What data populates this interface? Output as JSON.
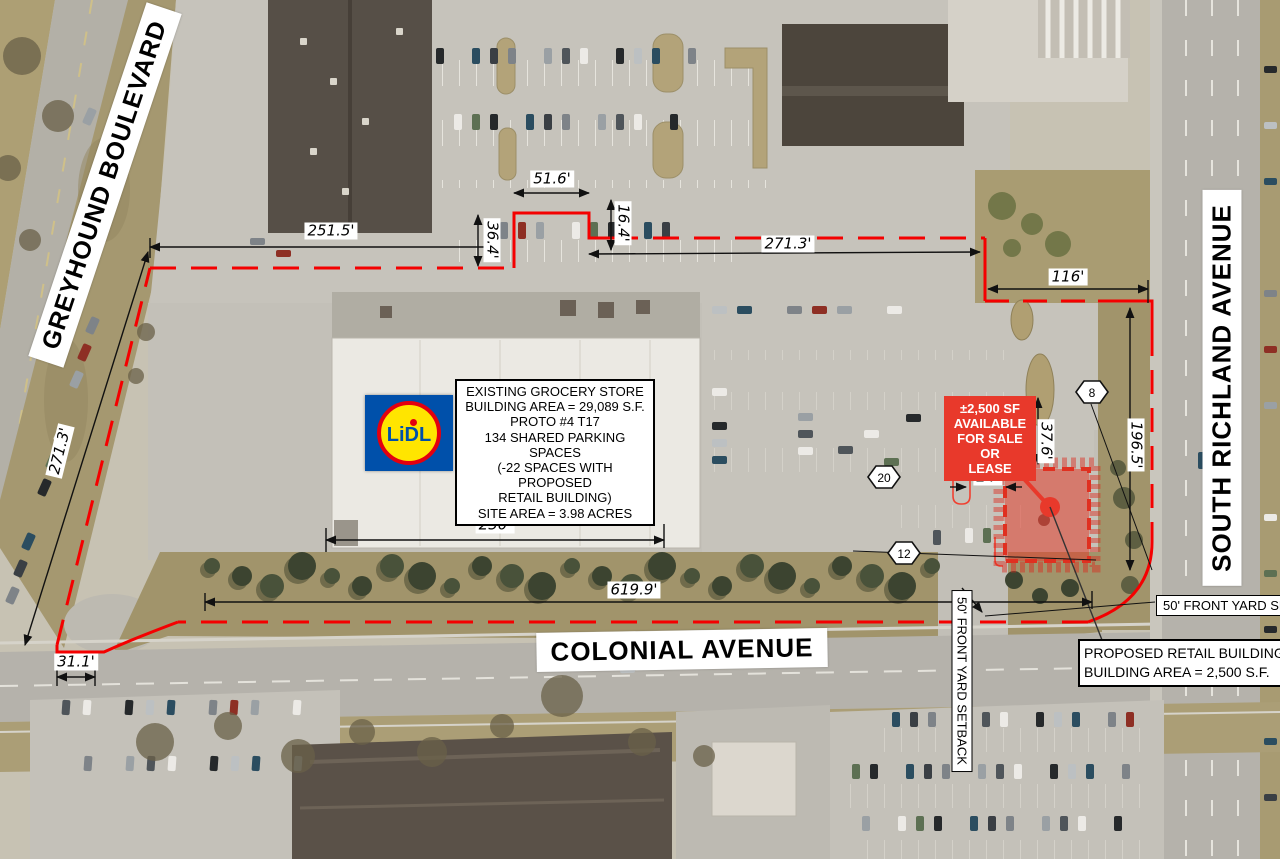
{
  "streets": {
    "greyhound": "GREYHOUND BOULEVARD",
    "colonial": "COLONIAL AVENUE",
    "richland": "SOUTH RICHLAND AVENUE"
  },
  "existing_store_box": {
    "l1": "EXISTING GROCERY STORE",
    "l2": "BUILDING AREA = 29,089 S.F.",
    "l3": "PROTO #4 T17",
    "l4": "134 SHARED PARKING SPACES",
    "l5": "(-22 SPACES WITH PROPOSED",
    "l6": "RETAIL BUILDING)",
    "l7": "SITE AREA = 3.98 ACRES"
  },
  "proposed_box": {
    "l1": "PROPOSED RETAIL BUILDING",
    "l2": "BUILDING AREA = 2,500 S.F."
  },
  "available_box": {
    "l1": "±2,500 SF",
    "l2": "AVAILABLE",
    "l3": "FOR SALE OR",
    "l4": "LEASE"
  },
  "setbacks": {
    "south": "50'  FRONT YARD SETBACK",
    "east": "50'  FRONT YARD SETBACK"
  },
  "dims": {
    "boundary_top_west": "251.5'",
    "stall_bay": "51.6'",
    "jog_east": "16.4'",
    "jog_west": "36.4'",
    "boundary_top_east": "271.3'",
    "boundary_ne": "116'",
    "boundary_west": "271.3'",
    "building_width": "250'",
    "frontage": "619.9'",
    "boundary_sw": "31.1'",
    "boundary_east": "196.5'",
    "drive_gap": "37.6'",
    "stall_depth": "24'"
  },
  "parking_badges": {
    "b8": "8",
    "b20": "20",
    "b12": "12"
  },
  "logo": {
    "brand": "LiDL"
  },
  "colors": {
    "boundary_red": "#ff0000",
    "marker_red": "#e8392b",
    "logo_blue": "#0050aa",
    "logo_yellow": "#ffe500",
    "logo_red": "#e3000f"
  }
}
